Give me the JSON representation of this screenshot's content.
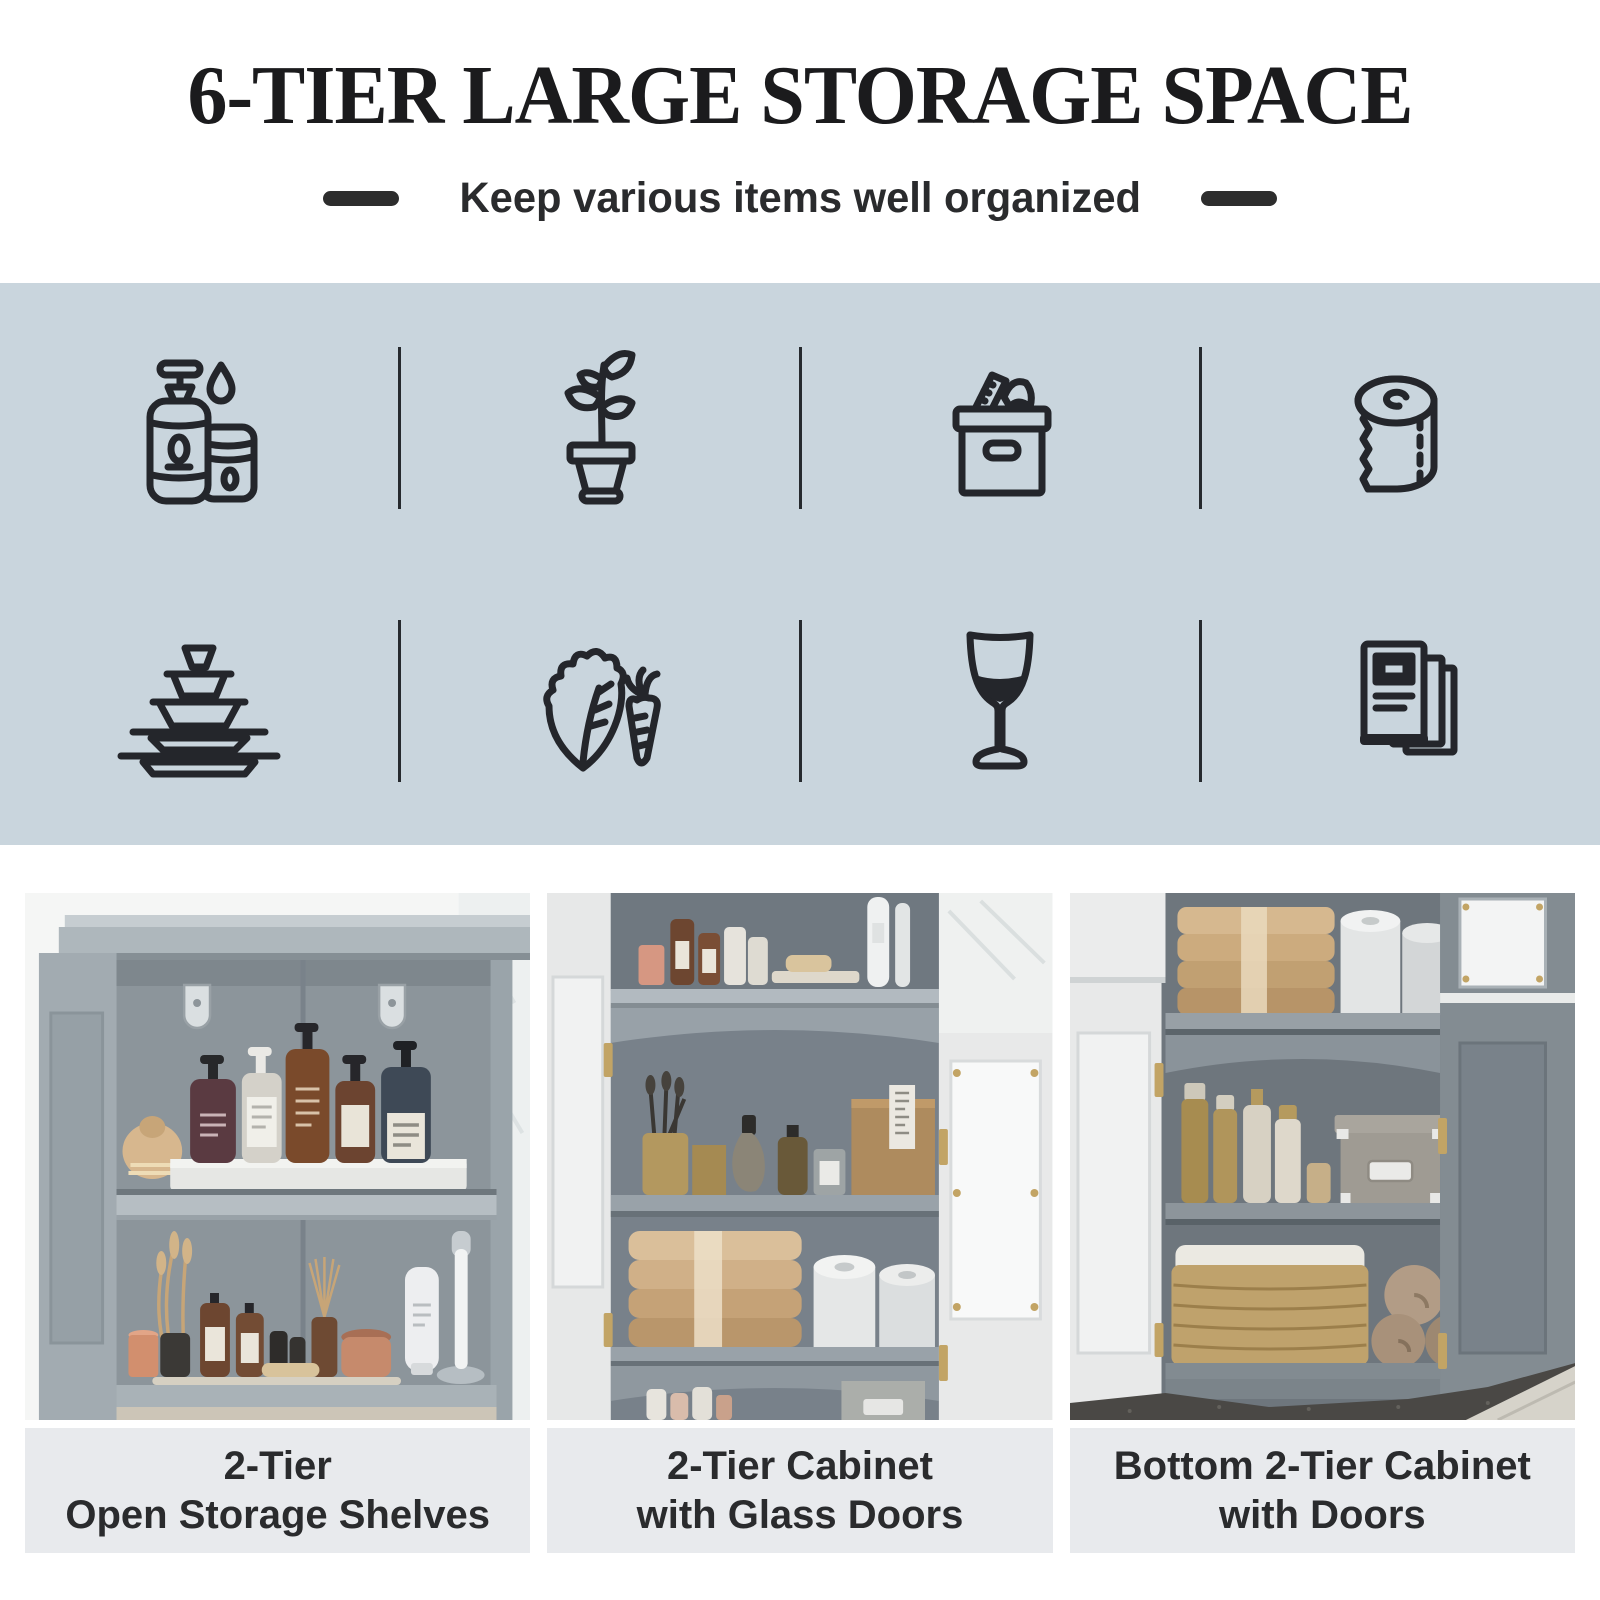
{
  "colors": {
    "band_bg": "#c9d5dd",
    "caption_bg": "#e8eaed",
    "icon_stroke": "#24262b",
    "title_color": "#1b1b1d",
    "text_color": "#2a2b2d",
    "dash_color": "#2d2d2d"
  },
  "header": {
    "title": "6-TIER LARGE STORAGE SPACE",
    "subtitle": "Keep various items well organized"
  },
  "icons": [
    {
      "name": "toiletries-icon"
    },
    {
      "name": "potted-plant-icon"
    },
    {
      "name": "storage-box-icon"
    },
    {
      "name": "paper-roll-icon"
    },
    {
      "name": "dishes-icon"
    },
    {
      "name": "vegetables-icon"
    },
    {
      "name": "wine-glass-icon"
    },
    {
      "name": "books-icon"
    }
  ],
  "photos": [
    {
      "alt": "open-storage-shelves-photo",
      "caption_line1": "2-Tier",
      "caption_line2": "Open Storage Shelves"
    },
    {
      "alt": "cabinet-with-glass-doors-photo",
      "caption_line1": "2-Tier Cabinet",
      "caption_line2": "with Glass Doors"
    },
    {
      "alt": "bottom-cabinet-with-doors-photo",
      "caption_line1": "Bottom 2-Tier Cabinet",
      "caption_line2": "with Doors"
    }
  ]
}
